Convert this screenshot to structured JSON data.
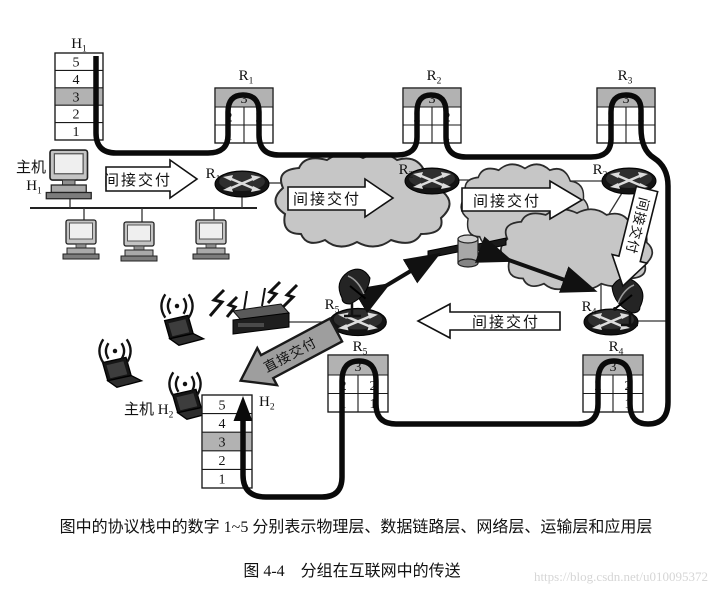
{
  "stacks": {
    "host_rows": [
      "5",
      "4",
      "3",
      "2",
      "1"
    ],
    "router": {
      "network": "3",
      "datalink": "2",
      "physical": "1"
    }
  },
  "labels": {
    "h1": {
      "base": "H",
      "sub": "1"
    },
    "h2": {
      "base": "H",
      "sub": "2"
    },
    "r1": {
      "base": "R",
      "sub": "1"
    },
    "r2": {
      "base": "R",
      "sub": "2"
    },
    "r3": {
      "base": "R",
      "sub": "3"
    },
    "r4": {
      "base": "R",
      "sub": "4"
    },
    "r5": {
      "base": "R",
      "sub": "5"
    },
    "host1_title": "主机",
    "host2_title": "主机 H"
  },
  "arrows": {
    "indirect": "间接交付",
    "direct": "直接交付"
  },
  "caption": {
    "note": "图中的协议栈中的数字 1~5 分别表示物理层、数据链路层、网络层、运输层和应用层",
    "title": "图 4-4　分组在互联网中的传送",
    "watermark": "https://blog.csdn.net/u010095372"
  },
  "colors": {
    "layer3_shade": "#b2b2b2",
    "cloud": "#c6c6c6",
    "packet_path": "#0a0a0a",
    "direct_arrow_fill": "#9e9e9e"
  }
}
